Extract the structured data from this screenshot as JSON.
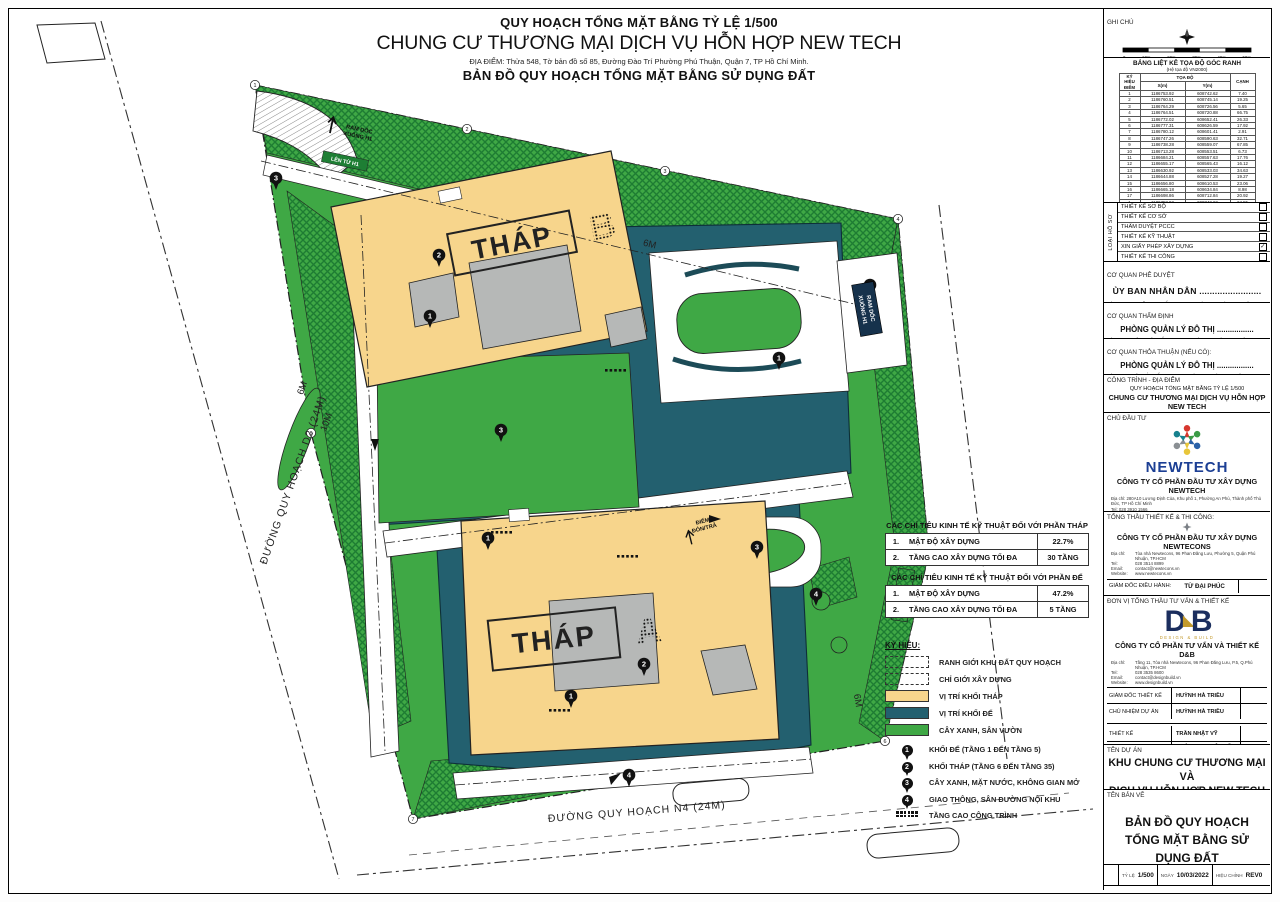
{
  "colors": {
    "green": "#3fa845",
    "green_dark": "#1e7c33",
    "podium": "#23606f",
    "tower": "#f7d58c",
    "core": "#b6b8b7",
    "newtech_blue": "#1c3f94",
    "db_navy": "#1b2e5e",
    "gold": "#c39a2b",
    "teal_dark": "#16324c"
  },
  "header": {
    "line1": "QUY HOẠCH TỔNG MẶT BẰNG TỶ LỆ 1/500",
    "line2": "CHUNG CƯ THƯƠNG MẠI DỊCH VỤ HỖN HỢP NEW TECH",
    "line3": "ĐỊA ĐIỂM: Thửa 548, Tờ bản đồ số 85, Đường Đào Trí Phường Phú Thuận, Quận 7, TP Hồ Chí Minh.",
    "line4": "BẢN ĐỒ QUY HOẠCH TỔNG MẶT BẰNG SỬ DỤNG ĐẤT"
  },
  "map": {
    "tower_b": "THÁP",
    "tower_b_letter": "B",
    "tower_a": "THÁP",
    "tower_a_letter": "A",
    "road_left": "ĐƯỜNG QUY HOẠCH D2 (24M)",
    "road_bottom": "ĐƯỜNG QUY HOẠCH N4 (24M)",
    "ramp_top_1": "RAM DỐC",
    "ramp_top_2": "XUỐNG H1",
    "ramp_sign": "LÊN TỪ H1",
    "ramp_right_1": "RAM DỐC",
    "ramp_right_2": "XUỐNG H1",
    "dropoff_1": "ĐIỂM",
    "dropoff_2": "ĐÓN/TRẢ",
    "dim_top": "6M",
    "dim_left1": "6M",
    "dim_left2": "10M",
    "dim_right": "6M",
    "pins": [
      {
        "n": "2",
        "x": 430,
        "y": 246
      },
      {
        "n": "1",
        "x": 421,
        "y": 307
      },
      {
        "n": "3",
        "x": 267,
        "y": 169
      },
      {
        "n": "3",
        "x": 492,
        "y": 421
      },
      {
        "n": "1",
        "x": 770,
        "y": 349
      },
      {
        "n": "4",
        "x": 861,
        "y": 276
      },
      {
        "n": "3",
        "x": 748,
        "y": 538
      },
      {
        "n": "2",
        "x": 635,
        "y": 655
      },
      {
        "n": "1",
        "x": 562,
        "y": 687
      },
      {
        "n": "4",
        "x": 807,
        "y": 585
      },
      {
        "n": "1",
        "x": 479,
        "y": 529
      },
      {
        "n": "4",
        "x": 620,
        "y": 766
      }
    ],
    "points": [
      {
        "n": "1",
        "x": 246,
        "y": 76
      },
      {
        "n": "2",
        "x": 458,
        "y": 120
      },
      {
        "n": "3",
        "x": 656,
        "y": 162
      },
      {
        "n": "4",
        "x": 889,
        "y": 210
      },
      {
        "n": "5",
        "x": 920,
        "y": 544
      },
      {
        "n": "6",
        "x": 876,
        "y": 732
      },
      {
        "n": "7",
        "x": 404,
        "y": 810
      },
      {
        "n": "8",
        "x": 302,
        "y": 424
      }
    ],
    "dotmarks": [
      {
        "x": 596,
        "y": 360
      },
      {
        "x": 482,
        "y": 522
      },
      {
        "x": 608,
        "y": 546
      },
      {
        "x": 540,
        "y": 700
      }
    ]
  },
  "eco": {
    "t1": {
      "title": "CÁC CHỈ TIÊU KINH TẾ KỸ THUẬT ĐỐI VỚI PHẦN THÁP",
      "r1n": "1.",
      "r1l": "MẬT ĐỘ XÂY DỰNG",
      "r1v": "22.7%",
      "r2n": "2.",
      "r2l": "TẦNG CAO XÂY DỰNG TỐI ĐA",
      "r2v": "30 TẦNG"
    },
    "t2": {
      "title": "CÁC CHỈ TIÊU KINH TẾ KỸ THUẬT ĐỐI VỚI PHẦN ĐẾ",
      "r1n": "1.",
      "r1l": "MẬT ĐỘ XÂY DỰNG",
      "r1v": "47.2%",
      "r2n": "2.",
      "r2l": "TẦNG CAO XÂY DỰNG TỐI ĐA",
      "r2v": "5 TẦNG"
    }
  },
  "legend": {
    "title": "KÝ HIỆU:",
    "sw": [
      "RANH GIỚI KHU ĐẤT QUY HOẠCH",
      "CHỈ GIỚI XÂY DỰNG",
      "VỊ TRÍ KHỐI THÁP",
      "VỊ TRÍ KHỐI ĐẾ",
      "CÂY XANH, SÂN VƯỜN"
    ],
    "markers": [
      {
        "num": "1",
        "label": "KHỐI ĐẾ (TẦNG 1 ĐẾN TẦNG 5)"
      },
      {
        "num": "2",
        "label": "KHỐI THÁP (TẦNG 6 ĐẾN TẦNG 35)"
      },
      {
        "num": "3",
        "label": "CÂY XANH, MẶT NƯỚC, KHÔNG GIAN MỞ"
      },
      {
        "num": "4",
        "label": "GIAO THÔNG, SÂN ĐƯỜNG NỘI KHU"
      }
    ],
    "dots_label": "TẦNG CAO CÔNG TRÌNH"
  },
  "sidebar": {
    "notes_label": "GHI CHÚ",
    "scale_ticks": [
      "0",
      "10m",
      "20m",
      "30m",
      "40m",
      "50m"
    ],
    "coord": {
      "title": "BẢNG LIỆT KÊ TỌA ĐỘ GÓC RANH",
      "subtitle": "(Hệ tọa độ VN2000)",
      "col_point": "KÝ HIỆU ĐIỂM",
      "col_coord": "TỌA ĐỘ",
      "col_x": "X(m)",
      "col_y": "Y(m)",
      "col_edge": "CẠNH",
      "rows": [
        {
          "n": "1",
          "x": "1186753.92",
          "y": "608742.62",
          "c": "7.40"
        },
        {
          "n": "2",
          "x": "1186760.51",
          "y": "608745.14",
          "c": "19.25"
        },
        {
          "n": "3",
          "x": "1186764.29",
          "y": "608726.56",
          "c": "5.65"
        },
        {
          "n": "4",
          "x": "1186764.51",
          "y": "608720.88",
          "c": "66.75"
        },
        {
          "n": "5",
          "x": "1186772.02",
          "y": "608652.41",
          "c": "26.33"
        },
        {
          "n": "6",
          "x": "1186777.31",
          "y": "608626.59",
          "c": "17.92"
        },
        {
          "n": "7",
          "x": "1186780.12",
          "y": "608601.41",
          "c": "2.91"
        },
        {
          "n": "8",
          "x": "1186747.26",
          "y": "608590.63",
          "c": "32.71"
        },
        {
          "n": "9",
          "x": "1186738.28",
          "y": "608559.07",
          "c": "67.85"
        },
        {
          "n": "10",
          "x": "1186713.28",
          "y": "608553.51",
          "c": "6.73"
        },
        {
          "n": "11",
          "x": "1186684.21",
          "y": "608557.63",
          "c": "17.76"
        },
        {
          "n": "12",
          "x": "1186655.17",
          "y": "608565.43",
          "c": "16.12"
        },
        {
          "n": "13",
          "x": "1186630.92",
          "y": "608533.03",
          "c": "34.63"
        },
        {
          "n": "14",
          "x": "1186644.88",
          "y": "608527.28",
          "c": "19.27"
        },
        {
          "n": "15",
          "x": "1186656.80",
          "y": "608610.53",
          "c": "23.06"
        },
        {
          "n": "16",
          "x": "1186665.18",
          "y": "608634.84",
          "c": "8.98"
        },
        {
          "n": "17",
          "x": "1186698.86",
          "y": "608712.84",
          "c": "20.92"
        },
        {
          "n": "1",
          "x": "1186753.92",
          "y": "608742.62",
          "c": "24.55"
        }
      ]
    },
    "dossier": {
      "side": "LOẠI HỒ SƠ",
      "items": [
        {
          "label": "THIẾT KẾ SƠ BỘ",
          "mark": ""
        },
        {
          "label": "THIẾT KẾ CƠ SỞ",
          "mark": ""
        },
        {
          "label": "THẨM DUYỆT PCCC",
          "mark": ""
        },
        {
          "label": "THIẾT KẾ KỸ THUẬT",
          "mark": ""
        },
        {
          "label": "XIN GIẤY PHÉP XÂY DỰNG",
          "mark": "✓"
        },
        {
          "label": "THIẾT KẾ THI CÔNG",
          "mark": ""
        }
      ]
    },
    "approve": {
      "label": "CƠ QUAN PHÊ DUYỆT",
      "agency": "ỦY BAN NHÂN DÂN ........................",
      "note": "KÈM THEO QUYẾT ĐỊNH SỐ .................. NGÀY ...... THÁNG ...... NĂM ......"
    },
    "review": {
      "label": "CƠ QUAN THẨM ĐỊNH",
      "agency": "PHÒNG QUẢN LÝ ĐÔ THỊ .................",
      "note": "KÈM THEO CÔNG VĂN SỐ .................. NGÀY ...... THÁNG ...... NĂM ......"
    },
    "agreement": {
      "label": "CƠ QUAN THỎA THUẬN (NẾU CÓ):",
      "agency": "PHÒNG QUẢN LÝ ĐÔ THỊ .................",
      "note": "KÈM THEO VĂN BẢN SỐ .................. NGÀY ...... THÁNG ...... NĂM ......"
    },
    "loc": {
      "label": "CÔNG TRÌNH - ĐỊA ĐIỂM",
      "line1": "QUY HOẠCH TỔNG MẶT BẰNG TỶ LỆ 1/500",
      "line2": "CHUNG CƯ THƯƠNG MẠI DỊCH VỤ HỖN HỢP NEW TECH",
      "line3": "(Địa chỉ: Thửa 548, Tờ bản đồ số 85, Đường Đào Trí, P. Phú Thuận, Quận 7, TP.HCM)"
    },
    "investor": {
      "label": "CHỦ ĐẦU TƯ",
      "logo": "NEWTECH",
      "name": "CÔNG TY CỔ PHẦN ĐẦU TƯ XÂY DỰNG NEWTECH",
      "addr1": "Địa chỉ:  280A10 Lương Định Của, Khu phố 1, Phường An Phú, Thành phố Thủ Đức, TP Hồ Chí Minh",
      "addr2": "Tel:       028 3910 1566",
      "gm_label": "TỔNG GIÁM ĐỐC:",
      "gm_name": "NGUYỄN TRƯỜNG SƠN"
    },
    "contractor": {
      "label": "TỔNG THẦU THIẾT KẾ & THI CÔNG:",
      "name": "CÔNG TY CỔ PHẦN ĐẦU TƯ XÂY DỰNG NEWTECONS",
      "contacts": [
        {
          "k": "Địa chỉ:",
          "v": "Tòa nhà Newtecons, 96 Phan Đăng Lưu, Phường 5, Quận Phú Nhuận, TP.HCM"
        },
        {
          "k": "Tel:",
          "v": "028 3514 8899"
        },
        {
          "k": "Email:",
          "v": "contact@newtecons.vn"
        },
        {
          "k": "Website:",
          "v": "www.newtecons.vn"
        }
      ],
      "exec_label": "GIÁM ĐỐC ĐIỀU HÀNH:",
      "exec_name": "TỪ ĐẠI PHÚC"
    },
    "designer": {
      "label": "ĐƠN VỊ TỔNG THẦU TƯ VẤN & THIẾT KẾ",
      "logo_d": "D",
      "logo_b": "B",
      "tagline": "DESIGN & BUILD",
      "name": "CÔNG TY CỔ PHẦN TƯ VẤN VÀ THIẾT KẾ D&B",
      "contacts": [
        {
          "k": "Địa chỉ:",
          "v": "Tầng 11, Tòa nhà Newtecons, 96 Phan Đăng Lưu, P.5, Q.Phú Nhuận, TP.HCM"
        },
        {
          "k": "Tel:",
          "v": "028 3535 8600"
        },
        {
          "k": "Email:",
          "v": "contact@designbuild.vn"
        },
        {
          "k": "Website:",
          "v": "www.designbuild.vn"
        }
      ],
      "roles1": [
        {
          "role": "GIÁM ĐỐC THIẾT KẾ",
          "name": "HUỲNH HÀ TRIỀU"
        },
        {
          "role": "CHỦ NHIỆM DỰ ÁN",
          "name": "HUỲNH HÀ TRIỀU"
        }
      ],
      "roles2": [
        {
          "role": "THIẾT KẾ",
          "name": "TRẦN NHẬT VỸ"
        },
        {
          "role": "THỂ HIỆN",
          "name": "HOÀNG NGUYỄN TẤN TÀI"
        },
        {
          "role": "QUẢN LÝ KỸ THUẬT",
          "name": "NGUYỄN ĐỨC LỢI"
        }
      ]
    },
    "project": {
      "label": "TÊN DỰ ÁN",
      "name1": "KHU CHUNG CƯ THƯƠNG MẠI VÀ",
      "name2": "DỊCH VỤ HỖN HỢP NEW TECH"
    },
    "drawing": {
      "label": "TÊN BẢN VẼ",
      "name1": "BẢN ĐỒ QUY HOẠCH",
      "name2": "TỔNG MẶT BẰNG SỬ DỤNG ĐẤT"
    },
    "meta": {
      "scale_label": "TỶ LỆ",
      "scale": "1/500",
      "date_label": "NGÀY",
      "date": "10/03/2022",
      "rev_label": "HIỆU CHỈNH",
      "rev": "REV0"
    },
    "sheetno_label": "SỐ BẢN VẼ:"
  }
}
